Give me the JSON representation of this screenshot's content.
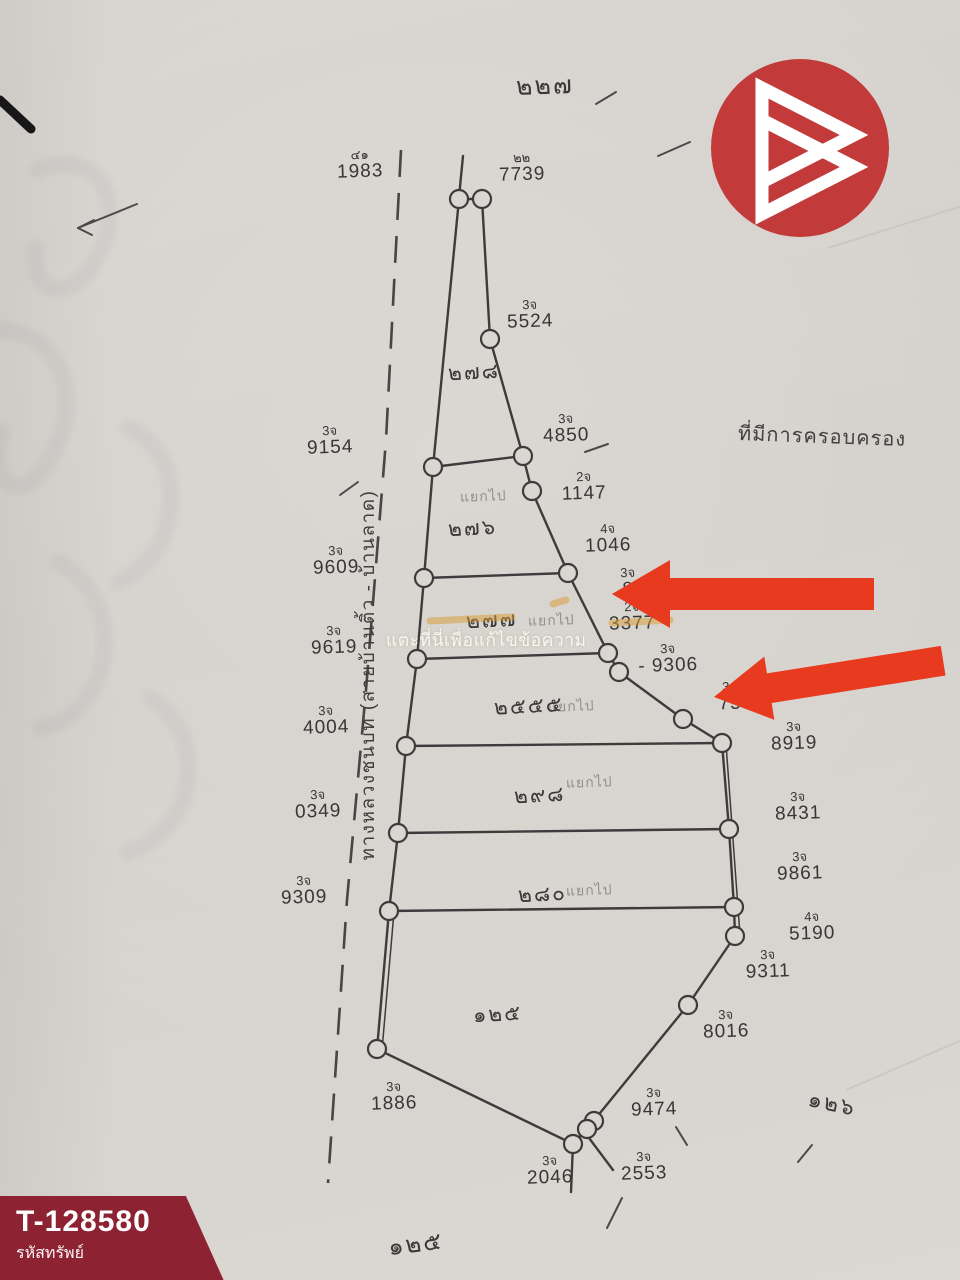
{
  "branding": {
    "code": "T-128580",
    "code_label": "รหัสทรัพย์",
    "banner_color": "#8d2232",
    "logo_color": "#c23a3a"
  },
  "watermark": {
    "text": "แตะที่นี่เพื่อแก้ไขข้อความ"
  },
  "map": {
    "road_label": "ทางหลวงชนบท (สายบ้านติ้ว - บ้านลาด)",
    "area_note": "ที่มีการครอบครอง",
    "sheet_no_top": "๒๒๗",
    "sheet_no_bottom": "๑๒๕",
    "sheet_no_right": "๑๒๖",
    "plots": [
      {
        "no": "๒๗๘",
        "note": "",
        "x": 448,
        "y": 356
      },
      {
        "no": "๒๗๖",
        "note": "แยกไป",
        "x": 448,
        "y": 512,
        "note_x": 460,
        "note_y": 486
      },
      {
        "no": "๒๗๗",
        "note": "แยกไป",
        "x": 466,
        "y": 604,
        "note_x": 528,
        "note_y": 610
      },
      {
        "no": "๒๕๕๕",
        "note": "แยกไป",
        "x": 494,
        "y": 690,
        "note_x": 548,
        "note_y": 696
      },
      {
        "no": "๒๙๘",
        "note": "แยกไป",
        "x": 514,
        "y": 779,
        "note_x": 566,
        "note_y": 772
      },
      {
        "no": "๒๘๐",
        "note": "แยกไป",
        "x": 518,
        "y": 878,
        "note_x": 566,
        "note_y": 880
      },
      {
        "no": "๑๒๕",
        "note": "",
        "x": 473,
        "y": 998
      }
    ],
    "markers": [
      {
        "pre": "๔๑",
        "num": "1983",
        "x": 322,
        "y": 148
      },
      {
        "pre": "๒๒",
        "num": "7739",
        "x": 484,
        "y": 151
      },
      {
        "pre": "3จ",
        "num": "5524",
        "x": 492,
        "y": 298
      },
      {
        "pre": "3จ",
        "num": "9154",
        "x": 292,
        "y": 424
      },
      {
        "pre": "3จ",
        "num": "4850",
        "x": 528,
        "y": 412
      },
      {
        "pre": "2จ",
        "num": "1147",
        "x": 546,
        "y": 470
      },
      {
        "pre": "4จ",
        "num": "1046",
        "x": 570,
        "y": 522
      },
      {
        "pre": "3จ",
        "num": "9609",
        "x": 298,
        "y": 544
      },
      {
        "pre": "3จ",
        "num": "8",
        "x": 590,
        "y": 566
      },
      {
        "pre": "2จ",
        "num": "3377",
        "x": 594,
        "y": 600
      },
      {
        "pre": "3จ",
        "num": "9619",
        "x": 296,
        "y": 624
      },
      {
        "pre": "3จ",
        "num": "- 9306",
        "x": 630,
        "y": 642
      },
      {
        "pre": "3จ",
        "num": "75",
        "x": 692,
        "y": 680
      },
      {
        "pre": "3จ",
        "num": "4004",
        "x": 288,
        "y": 704
      },
      {
        "pre": "3จ",
        "num": "8919",
        "x": 756,
        "y": 720
      },
      {
        "pre": "3จ",
        "num": "0349",
        "x": 280,
        "y": 788
      },
      {
        "pre": "3จ",
        "num": "8431",
        "x": 760,
        "y": 790
      },
      {
        "pre": "3จ",
        "num": "9861",
        "x": 762,
        "y": 850
      },
      {
        "pre": "3จ",
        "num": "9309",
        "x": 266,
        "y": 874
      },
      {
        "pre": "4จ",
        "num": "5190",
        "x": 774,
        "y": 910
      },
      {
        "pre": "3จ",
        "num": "9311",
        "x": 730,
        "y": 948
      },
      {
        "pre": "3จ",
        "num": "8016",
        "x": 688,
        "y": 1008
      },
      {
        "pre": "3จ",
        "num": "1886",
        "x": 356,
        "y": 1080
      },
      {
        "pre": "3จ",
        "num": "9474",
        "x": 616,
        "y": 1086
      },
      {
        "pre": "3จ",
        "num": "2553",
        "x": 606,
        "y": 1150
      },
      {
        "pre": "3จ",
        "num": "2046",
        "x": 512,
        "y": 1154
      }
    ],
    "arrows": [
      {
        "tx": 612,
        "ty": 594,
        "len": 262,
        "head": 58,
        "hh": 34,
        "bh": 16,
        "angle": 0,
        "color": "#e83a1f"
      },
      {
        "tx": 714,
        "ty": 697,
        "len": 232,
        "head": 56,
        "hh": 32,
        "bh": 15,
        "angle": -9,
        "color": "#e83a1f"
      }
    ],
    "geometry": {
      "outline_left": [
        [
          459,
          199
        ],
        [
          433,
          467
        ],
        [
          424,
          578
        ],
        [
          417,
          659
        ],
        [
          406,
          746
        ],
        [
          398,
          833
        ],
        [
          389,
          911
        ],
        [
          377,
          1049
        ]
      ],
      "outline_right": [
        [
          482,
          199
        ],
        [
          490,
          339
        ],
        [
          523,
          456
        ],
        [
          532,
          491
        ],
        [
          568,
          573
        ],
        [
          608,
          653
        ],
        [
          619,
          672
        ],
        [
          683,
          719
        ],
        [
          722,
          743
        ],
        [
          729,
          829
        ],
        [
          734,
          907
        ],
        [
          735,
          936
        ],
        [
          688,
          1005
        ],
        [
          587,
          1129
        ],
        [
          573,
          1144
        ]
      ],
      "top_edge": [
        [
          459,
          199
        ],
        [
          482,
          199
        ]
      ],
      "bottom_edge": [
        [
          377,
          1049
        ],
        [
          573,
          1144
        ]
      ],
      "divisions": [
        [
          [
            433,
            467
          ],
          [
            523,
            456
          ]
        ],
        [
          [
            424,
            578
          ],
          [
            568,
            573
          ]
        ],
        [
          [
            417,
            659
          ],
          [
            608,
            653
          ]
        ],
        [
          [
            406,
            746
          ],
          [
            722,
            743
          ]
        ],
        [
          [
            398,
            833
          ],
          [
            729,
            829
          ]
        ],
        [
          [
            389,
            911
          ],
          [
            734,
            907
          ]
        ]
      ],
      "stubs": [
        [
          463,
          156,
          459,
          197
        ],
        [
          573,
          1144,
          571,
          1192
        ],
        [
          589,
          1138,
          613,
          1170
        ]
      ],
      "double_strokes": [
        [
          726,
          744,
          740,
          935
        ],
        [
          394,
          912,
          382,
          1050
        ]
      ],
      "circles": [
        [
          459,
          199
        ],
        [
          482,
          199
        ],
        [
          490,
          339
        ],
        [
          433,
          467
        ],
        [
          523,
          456
        ],
        [
          532,
          491
        ],
        [
          424,
          578
        ],
        [
          568,
          573
        ],
        [
          417,
          659
        ],
        [
          608,
          653
        ],
        [
          619,
          672
        ],
        [
          683,
          719
        ],
        [
          406,
          746
        ],
        [
          722,
          743
        ],
        [
          398,
          833
        ],
        [
          729,
          829
        ],
        [
          389,
          911
        ],
        [
          734,
          907
        ],
        [
          735,
          936
        ],
        [
          688,
          1005
        ],
        [
          377,
          1049
        ],
        [
          594,
          1121
        ],
        [
          587,
          1129
        ],
        [
          573,
          1144
        ]
      ],
      "circle_r": 9,
      "road": [
        [
          401,
          150
        ],
        [
          386,
          440
        ],
        [
          366,
          690
        ],
        [
          347,
          900
        ],
        [
          328,
          1183
        ]
      ],
      "ticks": [
        [
          596,
          104,
          616,
          92
        ],
        [
          658,
          156,
          690,
          142
        ],
        [
          585,
          452,
          608,
          444
        ],
        [
          340,
          495,
          358,
          482
        ],
        [
          137,
          204,
          78,
          228
        ],
        [
          78,
          228,
          94,
          220
        ],
        [
          78,
          228,
          92,
          235
        ],
        [
          676,
          1127,
          687,
          1145
        ],
        [
          622,
          1198,
          607,
          1228
        ],
        [
          812,
          1145,
          798,
          1162
        ]
      ],
      "highlighter": [
        [
          430,
          621,
          512,
          617
        ],
        [
          612,
          623,
          670,
          620
        ],
        [
          553,
          604,
          566,
          600
        ]
      ],
      "creases": [
        [
          828,
          248,
          962,
          206
        ],
        [
          846,
          1090,
          962,
          1040
        ]
      ],
      "pen_mark": [
        0,
        100,
        31,
        129
      ],
      "ghosts": [
        "M38,170 C95,148 128,196 100,252 C72,308 28,296 36,248",
        "M-8,330 C58,326 92,398 44,468 C16,508 -14,478 2,432",
        "M128,428 C192,452 180,560 118,582",
        "M58,562 C132,602 112,716 40,728",
        "M150,698 C214,740 192,832 128,852"
      ]
    }
  }
}
